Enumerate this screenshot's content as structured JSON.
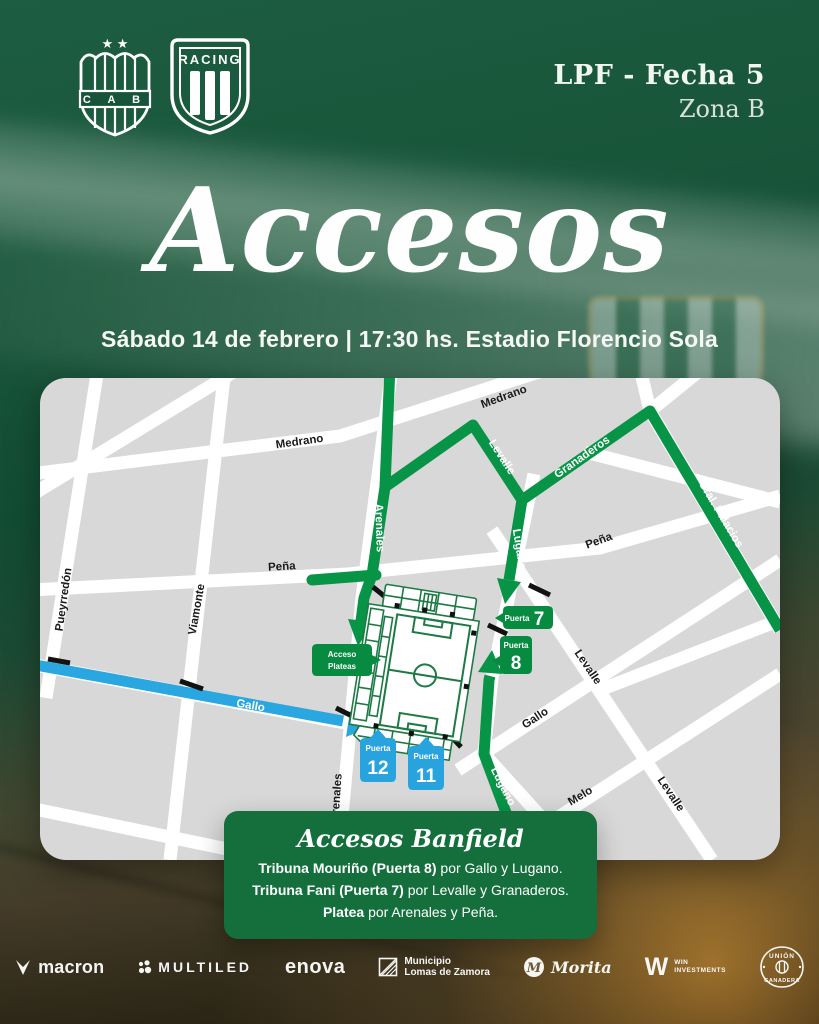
{
  "header": {
    "league": "LPF - Fecha 5",
    "zone": "Zona B",
    "banfield_initials": "C A B",
    "banfield_stars": "★ ★",
    "racing_label": "RACING"
  },
  "hero": {
    "title": "Accesos",
    "subtitle": "Sábado 14 de febrero | 17:30 hs. Estadio Florencio Sola"
  },
  "map": {
    "labels": {
      "medrano": "Medrano",
      "pena": "Peña",
      "pueyrredon": "Pueyrredón",
      "viamonte": "Viamonte",
      "arenales": "Arenales",
      "gallo": "Gallo",
      "melo": "Melo",
      "levalle": "Levalle",
      "lugano": "Lugano",
      "granaderos": "Granaderos",
      "gral_palacios": "Gral. Palacios"
    },
    "badges": {
      "acceso_plateas_line1": "Acceso",
      "acceso_plateas_line2": "Plateas",
      "puerta_label": "Puerta",
      "gate7": "7",
      "gate8": "8",
      "gate12": "12",
      "gate11": "11"
    },
    "colors": {
      "route_green": "#089447",
      "route_blue": "#2aa7e0",
      "badge_green": "#078b40",
      "badge_blue": "#29a3dd",
      "street_white": "#ffffff",
      "block_gray": "#d8d8d8"
    }
  },
  "info_box": {
    "title": "Accesos Banfield",
    "lines": [
      {
        "bold": "Tribuna Mouriño (Puerta 8)",
        "rest": " por Gallo y Lugano."
      },
      {
        "bold": "Tribuna Fani (Puerta 7)",
        "rest": " por Levalle y Granaderos."
      },
      {
        "bold": "Platea",
        "rest": " por Arenales y Peña."
      }
    ]
  },
  "sponsors": {
    "macron": "macron",
    "multiled": "MULTILED",
    "enova": "enova",
    "municipio_line1": "Municipio",
    "municipio_line2": "Lomas de Zamora",
    "morita": "Morita",
    "morita_initial": "M",
    "win_initial": "W",
    "win_line1": "WIN",
    "win_line2": "INVESTMENTS",
    "union_line1": "UNIÓN",
    "union_line2": "GANADERA"
  }
}
